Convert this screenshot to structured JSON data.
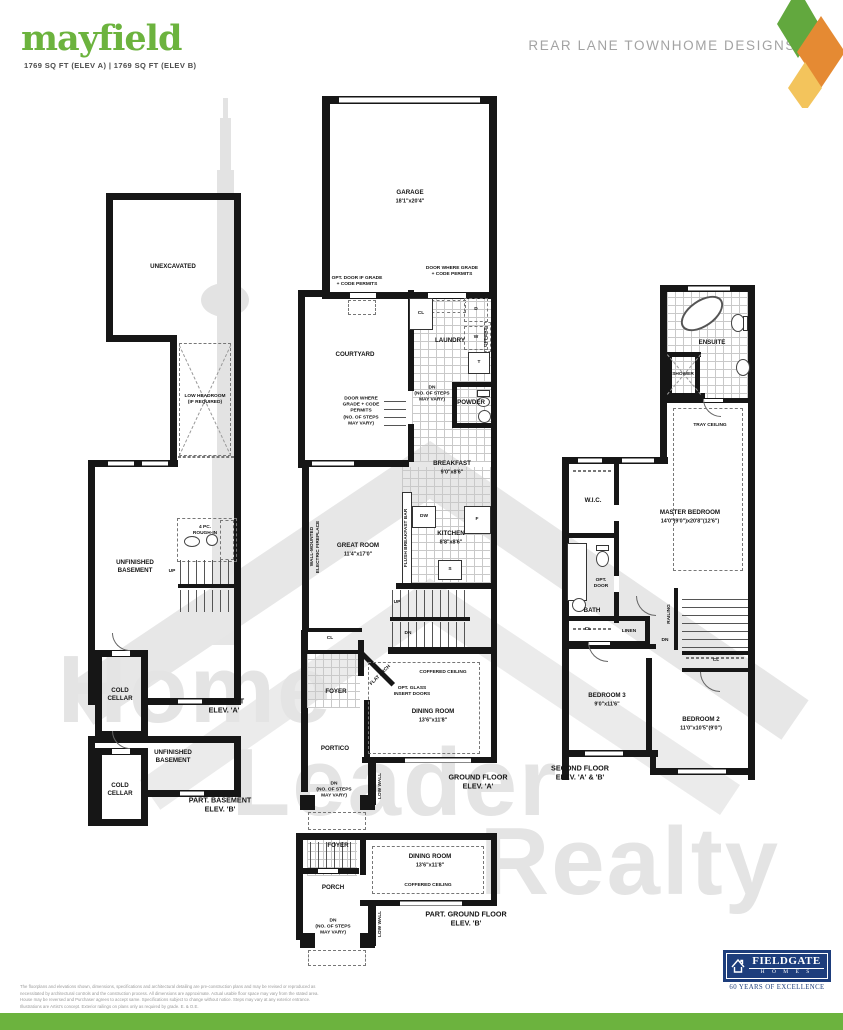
{
  "header": {
    "title": "mayfield",
    "subtitle": "1769 SQ FT (ELEV A)  |  1769 SQ FT (ELEV B)",
    "collection": "REAR LANE TOWNHOME DESIGNS"
  },
  "watermark": {
    "line1": "Home",
    "line2": "Leader",
    "line3": "Realty"
  },
  "colors": {
    "brand_green": "#6cb33e",
    "logo_blue": "#1d3d7c",
    "diamond_green": "#62a83e",
    "diamond_orange": "#e58a33",
    "diamond_yellow": "#f3c45c"
  },
  "plans": {
    "basement": {
      "unexcavated": "UNEXCAVATED",
      "low_headroom": "LOW HEADROOM\n(IF REQUIRED)",
      "rough_in": "4 PC.\nROUGH-IN",
      "up": "UP",
      "unfinished": "UNFINISHED\nBASEMENT",
      "cold_cellar": "COLD\nCELLAR",
      "elev": "BASEMENT\nELEV. 'A'"
    },
    "part_basement": {
      "unfinished": "UNFINISHED\nBASEMENT",
      "cold_cellar": "COLD\nCELLAR",
      "elev": "PART. BASEMENT\nELEV. 'B'"
    },
    "ground": {
      "garage": "GARAGE",
      "garage_dim": "18'1\"x20'4\"",
      "opt_door": "OPT. DOOR IF GRADE\n+ CODE PERMITS",
      "door_grade": "DOOR WHERE GRADE\n+ CODE PERMITS",
      "courtyard": "COURTYARD",
      "cl": "CL",
      "laundry": "LAUNDRY",
      "dryer": "D",
      "washer": "W",
      "tub": "T",
      "uppers": "UPPERS",
      "dn_steps": "DN\n(NO. OF STEPS\nMAY VARY)",
      "powder": "POWDER",
      "entry_note": "DOOR WHERE\nGRADE + CODE\nPERMITS\n(NO. OF STEPS\nMAY VARY)",
      "breakfast": "BREAKFAST",
      "breakfast_dim": "9'0\"x8'6\"",
      "flush_bar": "FLUSH BREAKFAST BAR",
      "dw": "DW",
      "fridge": "F",
      "sink": "S",
      "kitchen": "KITCHEN",
      "kitchen_dim": "8'8\"x8'6\"",
      "great_room": "GREAT ROOM",
      "great_room_dim": "11'4\"x17'0\"",
      "fireplace": "WALL-MOUNTED\nELECTRIC FIREPLACE",
      "up": "UP",
      "dn": "DN",
      "cl2": "CL",
      "foyer": "FOYER",
      "flat_arch": "FLAT ARCH",
      "opt_glass": "OPT. GLASS\nINSERT DOORS",
      "coffered": "COFFERED CEILING",
      "dining": "DINING ROOM",
      "dining_dim": "13'6\"x11'8\"",
      "portico": "PORTICO",
      "dn_steps2": "DN\n(NO. OF STEPS\nMAY VARY)",
      "low_wall": "LOW WALL",
      "elev": "GROUND FLOOR\nELEV. 'A'"
    },
    "part_ground": {
      "foyer": "FOYER",
      "dining": "DINING ROOM",
      "dining_dim": "13'6\"x11'8\"",
      "coffered": "COFFERED CEILING",
      "porch": "PORCH",
      "dn_steps": "DN\n(NO. OF STEPS\nMAY VARY)",
      "low_wall": "LOW WALL",
      "elev": "PART. GROUND FLOOR\nELEV. 'B'"
    },
    "second": {
      "ensuite": "ENSUITE",
      "shower": "SHOWER",
      "tray": "TRAY CEILING",
      "wic": "W.I.C.",
      "master": "MASTER BEDROOM",
      "master_dim": "14'0\"(9'0\")x20'8\"(12'6\")",
      "opt_door": "OPT.\nDOOR",
      "bath": "BATH",
      "cl": "CL",
      "linen": "LINEN",
      "railing": "RAILING",
      "dn": "DN",
      "cl2": "CL",
      "bedroom3": "BEDROOM 3",
      "bedroom3_dim": "9'0\"x11'6\"",
      "bedroom2": "BEDROOM 2",
      "bedroom2_dim": "11'0\"x10'5\"(9'0\")",
      "elev": "SECOND FLOOR\nELEV. 'A' & 'B'"
    }
  },
  "footer": {
    "disclaimer": "The floorplans and elevations shown, dimensions, specifications and architectural detailing are pre-construction plans and may be revised or reproduced as necessitated by architectural controls and the construction process. All dimensions are approximate. Actual usable floor space may vary from the stated area. House may be reversed and Purchaser agrees to accept same. Specifications subject to change without notice. Steps may vary at any exterior entrance. Illustrations are Artist's concept. Exterior railings on plans only as required by grade. E. & O.E.",
    "brand": "FIELDGATE",
    "brand_sub": "H O M E S",
    "tagline": "60 YEARS OF EXCELLENCE"
  }
}
